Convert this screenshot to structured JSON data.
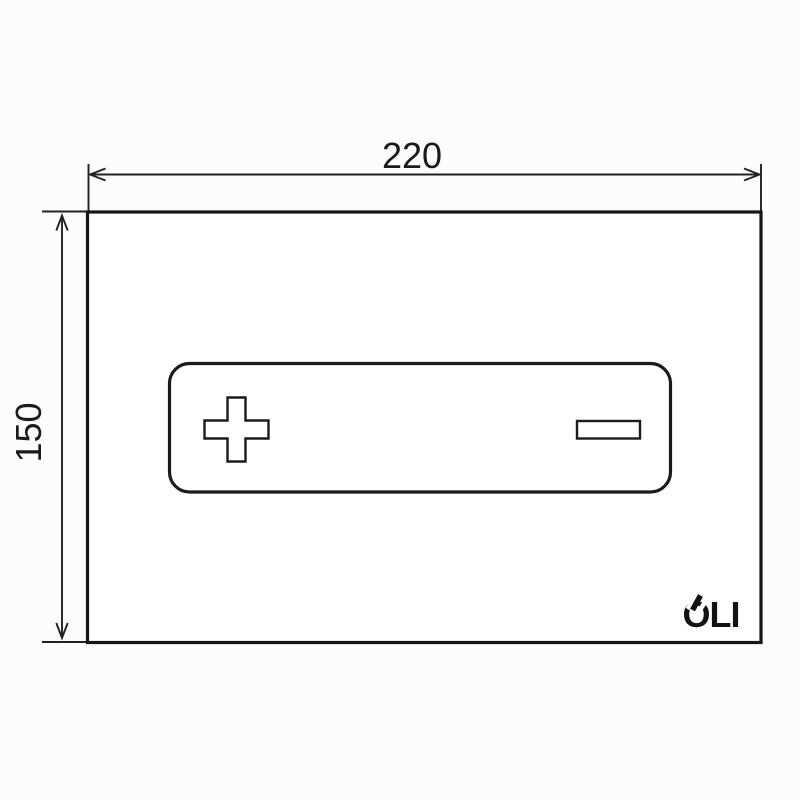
{
  "drawing": {
    "width_label": "220",
    "height_label": "150",
    "brand": "OLI"
  },
  "icons": {
    "plus_icon": "+",
    "minus_icon": "−"
  },
  "colors": {
    "line": "#1b1b1b",
    "background": "#fcfcfc",
    "plate_fill": "#ffffff"
  }
}
